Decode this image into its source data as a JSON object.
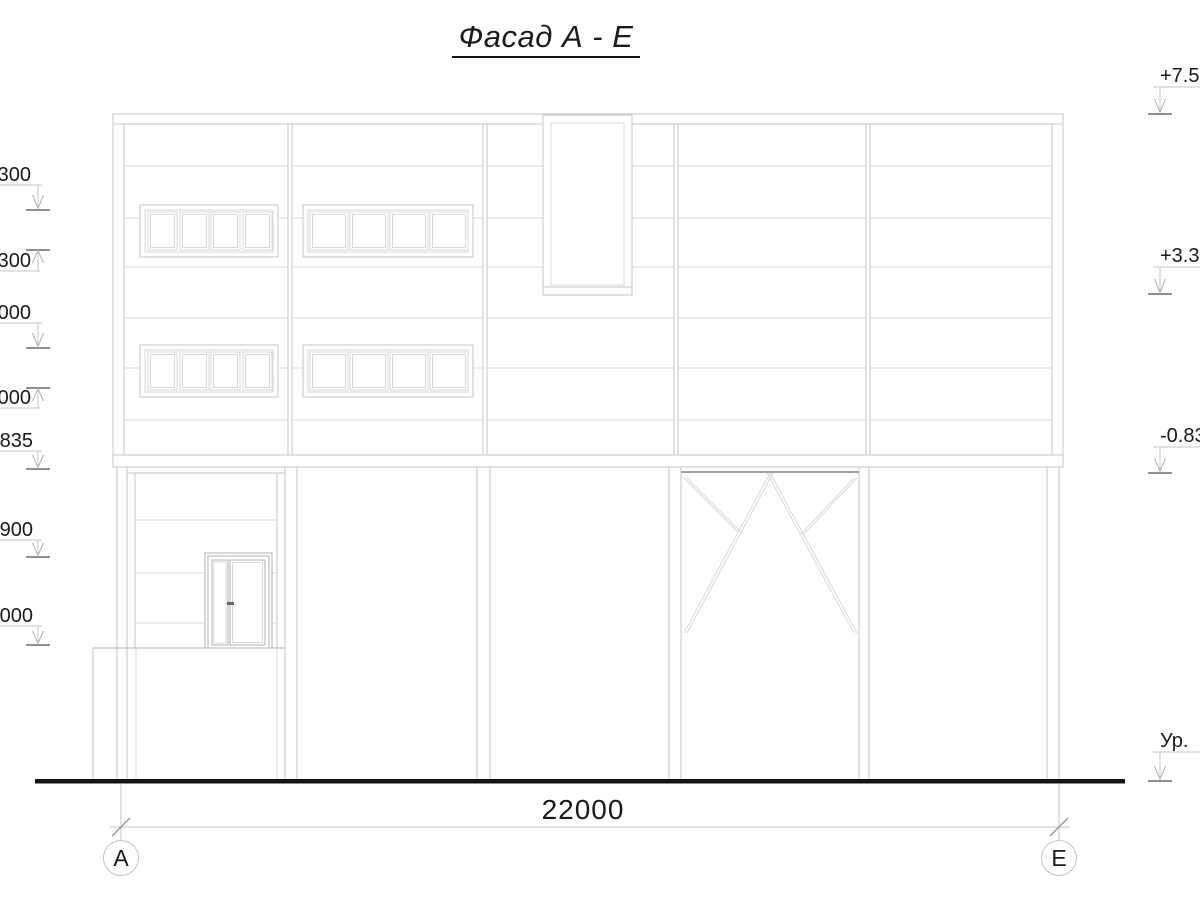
{
  "title": "Фасад А - Е",
  "levels_left": [
    "300",
    ".300",
    "000",
    ".000",
    ".835",
    ".900",
    ".000"
  ],
  "levels_right": [
    "+7.50",
    "+3.30",
    "-0.83",
    "Ур."
  ],
  "dimension": {
    "total": "22000"
  },
  "axes": {
    "left": "А",
    "right": "Е"
  }
}
